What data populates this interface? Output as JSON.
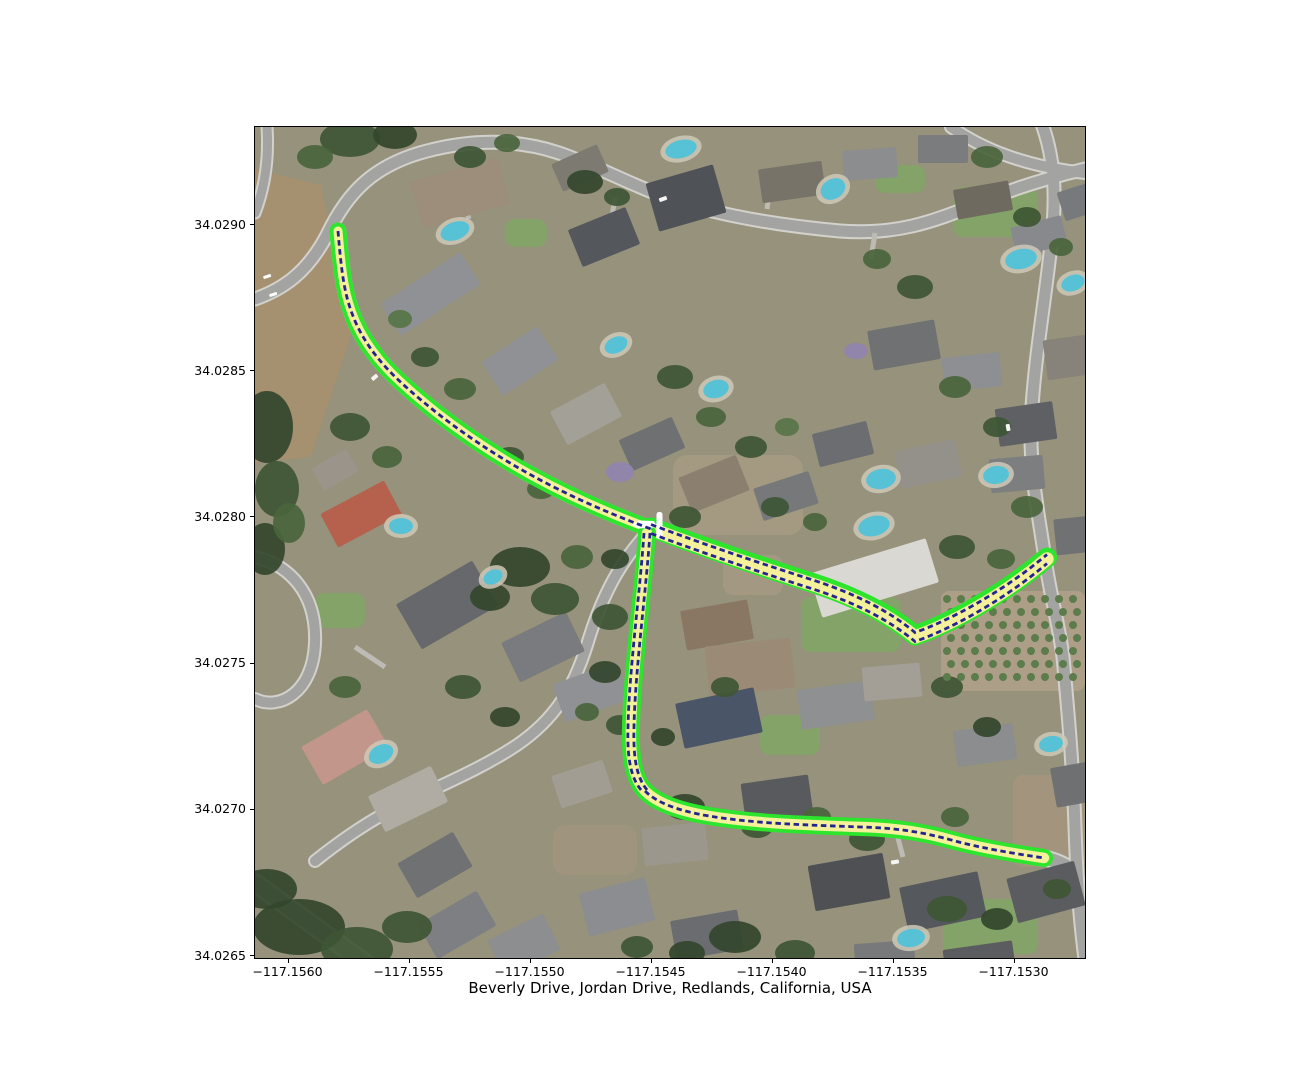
{
  "figure": {
    "title": "Beverly Drive, Jordan Drive, Redlands, California, USA",
    "x_axis": {
      "ticks": [
        "−117.1560",
        "−117.1555",
        "−117.1550",
        "−117.1545",
        "−117.1540",
        "−117.1535",
        "−117.1530"
      ]
    },
    "y_axis": {
      "ticks": [
        "34.0290",
        "34.0285",
        "34.0280",
        "34.0275",
        "34.0270",
        "34.0265"
      ]
    }
  },
  "map": {
    "kind": "aerial-imagery-with-highlighted-route",
    "routes": [
      {
        "name": "Beverly Drive"
      },
      {
        "name": "Jordan Drive"
      }
    ],
    "colors": {
      "route_outline_green": "#2ce52c",
      "route_fill_yellow": "#f4f19a",
      "route_centerline_navy": "#24248f",
      "intersection_marker_white": "#ffffff",
      "street_gray": "#a3a3a1"
    }
  }
}
